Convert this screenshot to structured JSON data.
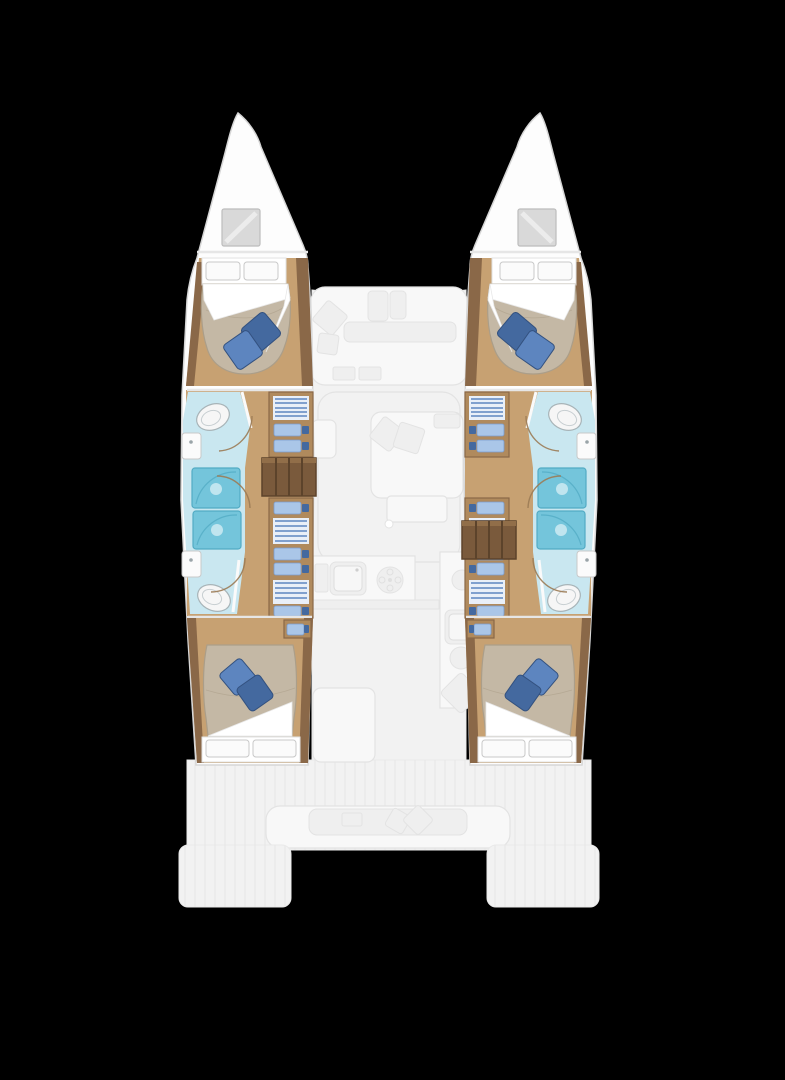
{
  "boat": {
    "type": "catamaran",
    "view": "overhead-deck-plan",
    "hulls": [
      "port",
      "starboard"
    ]
  },
  "areas": {
    "port_hull": [
      "bow-hatch",
      "forward-cabin-double-berth",
      "forward-bathroom",
      "shower-stalls",
      "wardrobe-shelves",
      "companionway-steps",
      "aft-bathroom",
      "aft-cabin-double-berth"
    ],
    "starboard_hull": [
      "bow-hatch",
      "forward-cabin-double-berth",
      "forward-bathroom",
      "shower-stalls",
      "wardrobe-shelves",
      "companionway-steps",
      "aft-bathroom",
      "aft-cabin-double-berth"
    ],
    "center": [
      "foredeck-seating",
      "saloon-sofa",
      "saloon-table",
      "galley-sink",
      "galley-stove",
      "aft-cockpit-bench",
      "transom-platforms"
    ]
  },
  "colors": {
    "bg": "#000000",
    "hull_fill": "#fdfdfd",
    "hull_stroke": "#d6d6d6",
    "deck_fill": "#f2f2f2",
    "deck_line": "#e9e9e9",
    "ghost_fill": "#f8f8f8",
    "ghost_stroke": "#e3e3e3",
    "ghost_inner": "#efefef",
    "wood_floor": "#c7a172",
    "wood_trim": "#8a6848",
    "wood_mid": "#b08a5d",
    "steps_fill": "#7a5a3c",
    "steps_line": "#5c432b",
    "steps_hi": "#916e49",
    "mattress_fill": "#c4b8a5",
    "mattress_stroke": "#ab9e89",
    "sheet_fill": "#ffffff",
    "pillow_white": "#fbfbfb",
    "pillow_stroke": "#c8c8c8",
    "pillow_blue_light": "#5d85bf",
    "pillow_blue_dark": "#44699f",
    "pillow_blue_stroke": "#33517f",
    "bath_floor": "#c9e7f0",
    "shower_fill": "#74c5db",
    "shower_stroke": "#52abc4",
    "fixture_fill": "#f6f6f6",
    "fixture_stroke": "#a8b4b8",
    "clothes_light": "#aac6e8",
    "clothes_dark": "#44699f",
    "clothes_stroke": "#7b9ccd",
    "hatch_fill": "#d9d9d9",
    "hatch_stroke": "#bdbdbd",
    "door_arc": "#9b7b55"
  }
}
